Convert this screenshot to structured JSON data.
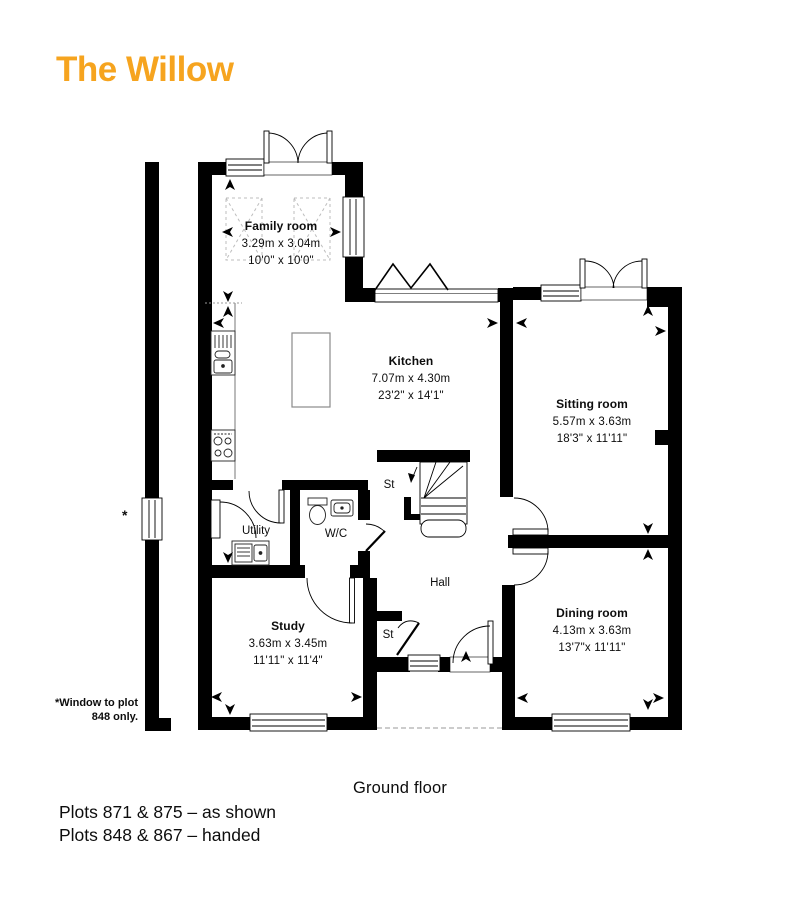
{
  "title": "The Willow",
  "colors": {
    "accent": "#F6A41F",
    "wall": "#000000"
  },
  "rooms": [
    {
      "name": "Family room",
      "metric": "3.29m x 3.04m",
      "imperial": "10'0\" x 10'0\""
    },
    {
      "name": "Kitchen",
      "metric": "7.07m x 4.30m",
      "imperial": "23'2\" x 14'1\""
    },
    {
      "name": "Sitting room",
      "metric": "5.57m x 3.63m",
      "imperial": "18'3\" x 11'11\""
    },
    {
      "name": "Utility"
    },
    {
      "name": "W/C"
    },
    {
      "name": "St"
    },
    {
      "name": "Hall"
    },
    {
      "name": "St"
    },
    {
      "name": "Study",
      "metric": "3.63m x 3.45m",
      "imperial": "11'11\" x 11'4\""
    },
    {
      "name": "Dining room",
      "metric": "4.13m x 3.63m",
      "imperial": "13'7\"x 11'11\""
    }
  ],
  "annotations": {
    "asterisk": "*",
    "window_note_line1": "*Window to plot",
    "window_note_line2": "848 only."
  },
  "footer": {
    "floor_label": "Ground floor",
    "plots_line1": "Plots 871 & 875 – as shown",
    "plots_line2": "Plots 848 & 867 – handed"
  }
}
